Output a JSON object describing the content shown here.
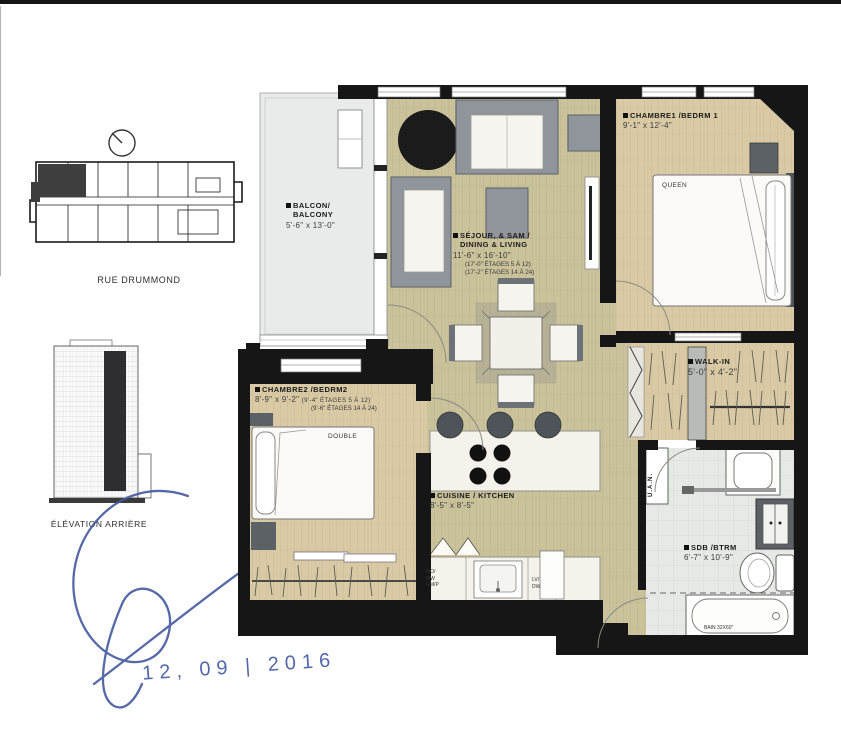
{
  "key_plan": {
    "street_label": "RUE DRUMMOND"
  },
  "elevation": {
    "caption": "ÉLÉVATION ARRIÈRE"
  },
  "annotation": {
    "date": "12, 09 | 2016",
    "ink_color": "#4157a2"
  },
  "plan": {
    "rooms": {
      "balcony": {
        "line1": "BALCON/",
        "line2": "BALCONY",
        "dims": "5'-6\" x 13'-0\""
      },
      "living": {
        "line1": "SÉJOUR, & SAM /",
        "line2": "DINING & LIVING",
        "dims": "11'-6\" x 16'-10\"",
        "note1": "(17'-0\" ÉTAGES 5 À 12)",
        "note2": "(17'-2\" ÉTAGES 14 À 24)"
      },
      "bedroom1": {
        "name": "CHAMBRE1 /BEDRM 1",
        "dims": "9'-1\" x 12'-4\""
      },
      "bedroom2": {
        "name": "CHAMBRE2 /BEDRM2",
        "dims": "8'-9\" x 9'-2\"",
        "note1": "(9'-4\" ÉTAGES 5 À 12)",
        "note2": "(9'-6\" ÉTAGES 14 À 24)"
      },
      "kitchen": {
        "name": "CUISINE / KITCHEN",
        "dims": "8'-5\" x 8'-5\""
      },
      "walk_in": {
        "name": "WALK-IN",
        "dims": "5'-0\" x 4'-2\""
      },
      "bathroom": {
        "name": "SDB /BTRM",
        "dims": "6'-7\" x 10'-9\""
      }
    },
    "fixtures": {
      "queen_bed": "QUEEN",
      "double_bed": "DOUBLE",
      "bathtub": "BAIN 32X60\"",
      "utility": "U.A.N.",
      "appl_l1": "MO/",
      "appl_l2": "MW",
      "appl_l3": "GM/P",
      "dw_l1": "LV/",
      "dw_l2": "DW"
    },
    "colors": {
      "floor_living": "#c9c29b",
      "floor_bedroom": "#d9caa5",
      "balcony_floor": "#e9ebea",
      "bathroom_floor": "#e7e9e6",
      "wall": "#161616",
      "furniture_gray": "#8f959b"
    }
  }
}
